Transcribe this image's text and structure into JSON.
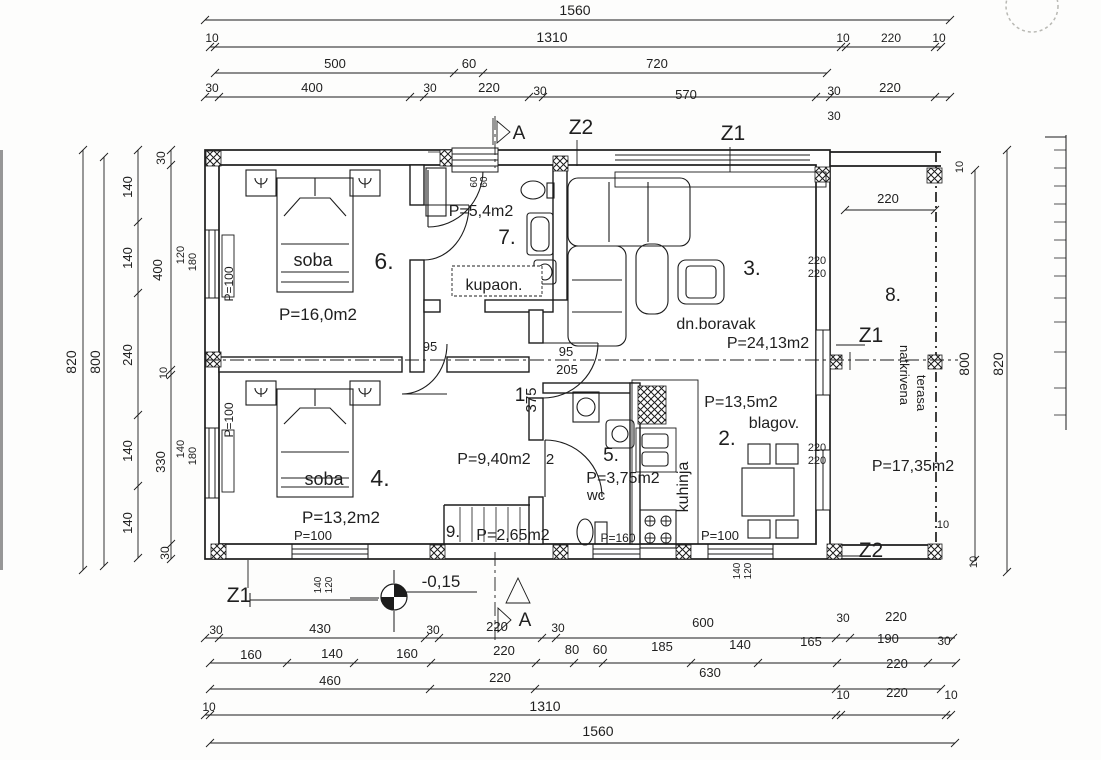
{
  "watermark": {
    "text": "INVESTA",
    "color": "#dadad7"
  },
  "colors": {
    "ink": "#1c1c1c",
    "paper": "#fdfdfc",
    "watermark": "#dadad7"
  },
  "rooms": [
    {
      "number": "1",
      "name": "",
      "area": "P=9,40m2"
    },
    {
      "number": "2.",
      "name": "blagov.",
      "area": "P=13,5m2"
    },
    {
      "number": "3.",
      "name": "dn.boravak",
      "area": "P=24,13m2"
    },
    {
      "number": "4.",
      "name": "soba",
      "area": "P=13,2m2"
    },
    {
      "number": "5.",
      "name": "wc",
      "area": "P=3,75m2"
    },
    {
      "number": "6.",
      "name": "soba",
      "area": "P=16,0m2"
    },
    {
      "number": "7.",
      "name": "kupaon.",
      "area": "P=5,4m2"
    },
    {
      "number": "8.",
      "name": "natkrivena terasa",
      "area": "P=17,35m2"
    },
    {
      "number": "9.",
      "name": "",
      "area": "P=2,65m2"
    }
  ],
  "section_markers": [
    "A",
    "Z1",
    "Z2"
  ],
  "level_label": "-0,15",
  "labels": [
    {
      "i": "dim-top-1560",
      "t": "1560",
      "x": 575,
      "y": 15,
      "s": 14
    },
    {
      "i": "dim-top-10-l",
      "t": "10",
      "x": 212,
      "y": 42,
      "s": 12
    },
    {
      "i": "dim-top-1310",
      "t": "1310",
      "x": 552,
      "y": 42,
      "s": 14
    },
    {
      "i": "dim-top-10-r1",
      "t": "10",
      "x": 843,
      "y": 42,
      "s": 12
    },
    {
      "i": "dim-top-220-r",
      "t": "220",
      "x": 891,
      "y": 42,
      "s": 12
    },
    {
      "i": "dim-top-10-r2",
      "t": "10",
      "x": 939,
      "y": 42,
      "s": 12
    },
    {
      "i": "dim-top-500",
      "t": "500",
      "x": 335,
      "y": 68,
      "s": 13
    },
    {
      "i": "dim-top-60",
      "t": "60",
      "x": 469,
      "y": 68,
      "s": 13
    },
    {
      "i": "dim-top-720",
      "t": "720",
      "x": 657,
      "y": 68,
      "s": 13
    },
    {
      "i": "dim-top-30-1",
      "t": "30",
      "x": 212,
      "y": 92,
      "s": 12
    },
    {
      "i": "dim-top-400",
      "t": "400",
      "x": 312,
      "y": 92,
      "s": 13
    },
    {
      "i": "dim-top-30-2",
      "t": "30",
      "x": 430,
      "y": 92,
      "s": 12
    },
    {
      "i": "dim-top-220-m",
      "t": "220",
      "x": 489,
      "y": 92,
      "s": 13
    },
    {
      "i": "dim-top-30-3",
      "t": "30",
      "x": 540,
      "y": 95,
      "s": 12
    },
    {
      "i": "dim-top-570",
      "t": "570",
      "x": 686,
      "y": 99,
      "s": 13
    },
    {
      "i": "dim-top-30-4",
      "t": "30",
      "x": 834,
      "y": 95,
      "s": 12
    },
    {
      "i": "dim-top-220-m2",
      "t": "220",
      "x": 890,
      "y": 92,
      "s": 13
    },
    {
      "i": "dim-top-30-5",
      "t": "30",
      "x": 834,
      "y": 120,
      "s": 12
    },
    {
      "i": "section-a-top",
      "t": "A",
      "x": 519,
      "y": 139,
      "s": 19
    },
    {
      "i": "section-z2-top",
      "t": "Z2",
      "x": 581,
      "y": 134,
      "s": 21
    },
    {
      "i": "section-z1-top",
      "t": "Z1",
      "x": 733,
      "y": 140,
      "s": 21
    },
    {
      "i": "dim-left-820",
      "t": "820",
      "x": 76,
      "y": 362,
      "s": 14,
      "r": -90
    },
    {
      "i": "dim-left-800",
      "t": "800",
      "x": 100,
      "y": 362,
      "s": 14,
      "r": -90
    },
    {
      "i": "dim-left-140-1",
      "t": "140",
      "x": 132,
      "y": 187,
      "s": 13,
      "r": -90
    },
    {
      "i": "dim-left-140-2",
      "t": "140",
      "x": 132,
      "y": 258,
      "s": 13,
      "r": -90
    },
    {
      "i": "dim-left-240",
      "t": "240",
      "x": 132,
      "y": 355,
      "s": 13,
      "r": -90
    },
    {
      "i": "dim-left-140-3",
      "t": "140",
      "x": 132,
      "y": 451,
      "s": 13,
      "r": -90
    },
    {
      "i": "dim-left-140-4",
      "t": "140",
      "x": 132,
      "y": 523,
      "s": 13,
      "r": -90
    },
    {
      "i": "dim-left-30-1",
      "t": "30",
      "x": 165,
      "y": 158,
      "s": 12,
      "r": -90
    },
    {
      "i": "dim-left-400",
      "t": "400",
      "x": 162,
      "y": 270,
      "s": 13,
      "r": -90
    },
    {
      "i": "dim-left-10",
      "t": "10",
      "x": 167,
      "y": 373,
      "s": 11,
      "r": -90
    },
    {
      "i": "dim-left-330",
      "t": "330",
      "x": 165,
      "y": 462,
      "s": 13,
      "r": -90
    },
    {
      "i": "dim-left-30-2",
      "t": "30",
      "x": 169,
      "y": 553,
      "s": 12,
      "r": -90
    },
    {
      "i": "win-left-120",
      "t": "120",
      "x": 184,
      "y": 255,
      "s": 11,
      "r": -90
    },
    {
      "i": "win-left-180a",
      "t": "180",
      "x": 196,
      "y": 262,
      "s": 11,
      "r": -90
    },
    {
      "i": "win-left-140",
      "t": "140",
      "x": 184,
      "y": 449,
      "s": 11,
      "r": -90
    },
    {
      "i": "win-left-180b",
      "t": "180",
      "x": 196,
      "y": 456,
      "s": 11,
      "r": -90
    },
    {
      "i": "win-room6-p100",
      "t": "P=100",
      "x": 233,
      "y": 284,
      "s": 12,
      "r": -90
    },
    {
      "i": "win-room4-p100-l",
      "t": "P=100",
      "x": 233,
      "y": 420,
      "s": 12,
      "r": -90
    },
    {
      "i": "dim-right-10-top",
      "t": "10",
      "x": 963,
      "y": 167,
      "s": 11,
      "r": -90
    },
    {
      "i": "dim-right-800",
      "t": "800",
      "x": 969,
      "y": 364,
      "s": 14,
      "r": -90
    },
    {
      "i": "dim-right-820",
      "t": "820",
      "x": 1003,
      "y": 364,
      "s": 14,
      "r": -90
    },
    {
      "i": "dim-right-10-bot",
      "t": "10",
      "x": 977,
      "y": 562,
      "s": 11,
      "r": -90
    },
    {
      "i": "dim-terasa-220",
      "t": "220",
      "x": 888,
      "y": 203,
      "s": 13
    },
    {
      "i": "dim-terasa-10",
      "t": "10",
      "x": 943,
      "y": 528,
      "s": 11
    },
    {
      "i": "dim-220-liv-a",
      "t": "220",
      "x": 817,
      "y": 264,
      "s": 11
    },
    {
      "i": "dim-220-liv-b",
      "t": "220",
      "x": 817,
      "y": 277,
      "s": 11
    },
    {
      "i": "dim-220-din-a",
      "t": "220",
      "x": 817,
      "y": 451,
      "s": 11
    },
    {
      "i": "dim-220-din-b",
      "t": "220",
      "x": 817,
      "y": 464,
      "s": 11
    },
    {
      "i": "section-z1-right",
      "t": "Z1",
      "x": 871,
      "y": 342,
      "s": 21
    },
    {
      "i": "section-z2-right",
      "t": "Z2",
      "x": 871,
      "y": 557,
      "s": 21
    },
    {
      "i": "room6-name",
      "t": "soba",
      "x": 313,
      "y": 266,
      "s": 18
    },
    {
      "i": "room6-number",
      "t": "6.",
      "x": 384,
      "y": 269,
      "s": 23
    },
    {
      "i": "room6-area",
      "t": "P=16,0m2",
      "x": 318,
      "y": 320,
      "s": 17
    },
    {
      "i": "room7-area",
      "t": "P=5,4m2",
      "x": 481,
      "y": 216,
      "s": 16
    },
    {
      "i": "room7-number",
      "t": "7.",
      "x": 507,
      "y": 244,
      "s": 21
    },
    {
      "i": "room7-name",
      "t": "kupaon.",
      "x": 494,
      "y": 290,
      "s": 16
    },
    {
      "i": "room3-number",
      "t": "3.",
      "x": 752,
      "y": 275,
      "s": 21
    },
    {
      "i": "room3-name",
      "t": "dn.boravak",
      "x": 716,
      "y": 329,
      "s": 16
    },
    {
      "i": "room3-area",
      "t": "P=24,13m2",
      "x": 768,
      "y": 348,
      "s": 16
    },
    {
      "i": "room8-number",
      "t": "8.",
      "x": 893,
      "y": 301,
      "s": 19
    },
    {
      "i": "room8-name-1",
      "t": "natkrivena",
      "x": 900,
      "y": 375,
      "s": 13,
      "r": 90
    },
    {
      "i": "room8-name-2",
      "t": "terasa",
      "x": 917,
      "y": 393,
      "s": 13,
      "r": 90
    },
    {
      "i": "room8-area",
      "t": "P=17,35m2",
      "x": 913,
      "y": 471,
      "s": 16
    },
    {
      "i": "room1-number",
      "t": "1",
      "x": 520,
      "y": 401,
      "s": 19
    },
    {
      "i": "dim-375",
      "t": "375",
      "x": 536,
      "y": 400,
      "s": 15,
      "r": -90
    },
    {
      "i": "dim-95-a",
      "t": "95",
      "x": 430,
      "y": 351,
      "s": 13
    },
    {
      "i": "dim-95-b",
      "t": "95",
      "x": 566,
      "y": 356,
      "s": 13
    },
    {
      "i": "dim-205",
      "t": "205",
      "x": 567,
      "y": 374,
      "s": 13
    },
    {
      "i": "room1-area",
      "t": "P=9,40m2",
      "x": 494,
      "y": 464,
      "s": 16
    },
    {
      "i": "room1-extra-2",
      "t": "2",
      "x": 550,
      "y": 464,
      "s": 15
    },
    {
      "i": "room4-name",
      "t": "soba",
      "x": 324,
      "y": 485,
      "s": 18
    },
    {
      "i": "room4-number",
      "t": "4.",
      "x": 380,
      "y": 486,
      "s": 23
    },
    {
      "i": "room4-area",
      "t": "P=13,2m2",
      "x": 341,
      "y": 523,
      "s": 17
    },
    {
      "i": "win-room4-p100-b",
      "t": "P=100",
      "x": 313,
      "y": 540,
      "s": 13
    },
    {
      "i": "room9-number",
      "t": "9.",
      "x": 453,
      "y": 537,
      "s": 17
    },
    {
      "i": "room9-area",
      "t": "P=2,65m2",
      "x": 513,
      "y": 540,
      "s": 16
    },
    {
      "i": "room5-number",
      "t": "5.",
      "x": 611,
      "y": 461,
      "s": 19
    },
    {
      "i": "room5-area",
      "t": "P=3,75m2",
      "x": 623,
      "y": 483,
      "s": 16
    },
    {
      "i": "room5-name",
      "t": "wc",
      "x": 596,
      "y": 500,
      "s": 15
    },
    {
      "i": "win-wc-p160",
      "t": "P=160",
      "x": 618,
      "y": 542,
      "s": 12
    },
    {
      "i": "kitchen-name",
      "t": "kuhinja",
      "x": 688,
      "y": 487,
      "s": 16,
      "r": -90
    },
    {
      "i": "room2-area",
      "t": "P=13,5m2",
      "x": 741,
      "y": 407,
      "s": 16
    },
    {
      "i": "room2-name",
      "t": "blagov.",
      "x": 774,
      "y": 428,
      "s": 16
    },
    {
      "i": "room2-number",
      "t": "2.",
      "x": 727,
      "y": 445,
      "s": 21
    },
    {
      "i": "win-blagov-p100",
      "t": "P=100",
      "x": 720,
      "y": 540,
      "s": 13
    },
    {
      "i": "win-blagov-140",
      "t": "140",
      "x": 740,
      "y": 571,
      "s": 10,
      "r": -90
    },
    {
      "i": "win-blagov-120",
      "t": "120",
      "x": 751,
      "y": 571,
      "s": 10,
      "r": -90
    },
    {
      "i": "entr-60-a",
      "t": "60",
      "x": 477,
      "y": 182,
      "s": 10,
      "r": -90
    },
    {
      "i": "entr-60-b",
      "t": "60",
      "x": 487,
      "y": 182,
      "s": 10,
      "r": -90
    },
    {
      "i": "level-label",
      "t": "-0,15",
      "x": 441,
      "y": 587,
      "s": 17
    },
    {
      "i": "section-a-bottom",
      "t": "A",
      "x": 525,
      "y": 626,
      "s": 19
    },
    {
      "i": "section-z1-bottom",
      "t": "Z1",
      "x": 239,
      "y": 602,
      "s": 21
    },
    {
      "i": "win-room4b-140",
      "t": "140",
      "x": 321,
      "y": 585,
      "s": 10,
      "r": -90
    },
    {
      "i": "win-room4b-120",
      "t": "120",
      "x": 332,
      "y": 585,
      "s": 10,
      "r": -90
    },
    {
      "i": "dim-bot1-30a",
      "t": "30",
      "x": 216,
      "y": 634,
      "s": 12
    },
    {
      "i": "dim-bot1-430",
      "t": "430",
      "x": 320,
      "y": 633,
      "s": 13
    },
    {
      "i": "dim-bot1-30b",
      "t": "30",
      "x": 433,
      "y": 634,
      "s": 12
    },
    {
      "i": "dim-bot1-220",
      "t": "220",
      "x": 497,
      "y": 631,
      "s": 13
    },
    {
      "i": "dim-bot1-30c",
      "t": "30",
      "x": 558,
      "y": 632,
      "s": 12
    },
    {
      "i": "dim-bot1-600",
      "t": "600",
      "x": 703,
      "y": 627,
      "s": 13
    },
    {
      "i": "dim-bot1-30d",
      "t": "30",
      "x": 843,
      "y": 622,
      "s": 12
    },
    {
      "i": "dim-bot1-220b",
      "t": "220",
      "x": 896,
      "y": 621,
      "s": 13
    },
    {
      "i": "dim-bot2-160a",
      "t": "160",
      "x": 251,
      "y": 659,
      "s": 13
    },
    {
      "i": "dim-bot2-140a",
      "t": "140",
      "x": 332,
      "y": 658,
      "s": 13
    },
    {
      "i": "dim-bot2-160b",
      "t": "160",
      "x": 407,
      "y": 658,
      "s": 13
    },
    {
      "i": "dim-bot2-220",
      "t": "220",
      "x": 504,
      "y": 655,
      "s": 13
    },
    {
      "i": "dim-bot2-80",
      "t": "80",
      "x": 572,
      "y": 654,
      "s": 13
    },
    {
      "i": "dim-bot2-60",
      "t": "60",
      "x": 600,
      "y": 654,
      "s": 13
    },
    {
      "i": "dim-bot2-185",
      "t": "185",
      "x": 662,
      "y": 651,
      "s": 13
    },
    {
      "i": "dim-bot2-140b",
      "t": "140",
      "x": 740,
      "y": 649,
      "s": 13
    },
    {
      "i": "dim-bot2-165",
      "t": "165",
      "x": 811,
      "y": 646,
      "s": 13
    },
    {
      "i": "dim-bot2-190",
      "t": "190",
      "x": 888,
      "y": 643,
      "s": 13
    },
    {
      "i": "dim-bot2-30",
      "t": "30",
      "x": 944,
      "y": 645,
      "s": 12
    },
    {
      "i": "dim-bot3-460",
      "t": "460",
      "x": 330,
      "y": 685,
      "s": 13
    },
    {
      "i": "dim-bot3-220a",
      "t": "220",
      "x": 500,
      "y": 682,
      "s": 13
    },
    {
      "i": "dim-bot3-630",
      "t": "630",
      "x": 710,
      "y": 677,
      "s": 13
    },
    {
      "i": "dim-bot3-220b",
      "t": "220",
      "x": 897,
      "y": 668,
      "s": 13
    },
    {
      "i": "dim-bot4-10a",
      "t": "10",
      "x": 209,
      "y": 711,
      "s": 12
    },
    {
      "i": "dim-bot4-1310",
      "t": "1310",
      "x": 545,
      "y": 711,
      "s": 14
    },
    {
      "i": "dim-bot4-10b",
      "t": "10",
      "x": 843,
      "y": 699,
      "s": 12
    },
    {
      "i": "dim-bot4-220",
      "t": "220",
      "x": 897,
      "y": 697,
      "s": 13
    },
    {
      "i": "dim-bot4-10c",
      "t": "10",
      "x": 951,
      "y": 699,
      "s": 12
    },
    {
      "i": "dim-bot5-1560",
      "t": "1560",
      "x": 598,
      "y": 736,
      "s": 14
    }
  ]
}
